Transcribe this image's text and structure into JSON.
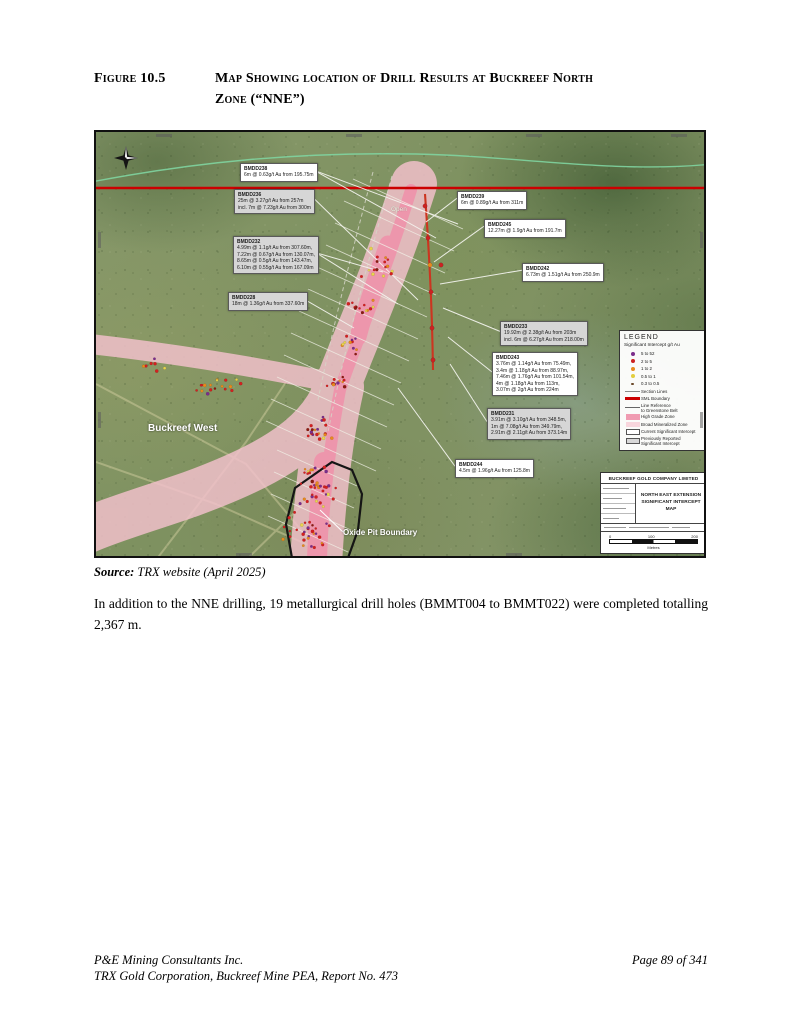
{
  "figure": {
    "label": "Figure 10.5",
    "title_line1": "Map Showing location of Drill Results at Buckreef North",
    "title_line2": "Zone (“NNE”)"
  },
  "source": {
    "prefix": "Source:",
    "text": " TRX website (April 2025)"
  },
  "body": "In addition to the NNE drilling, 19 metallurgical drill holes (BMMT004 to BMMT022) were completed totalling 2,367 m.",
  "footer": {
    "line1": "P&E Mining Consultants Inc.",
    "line2": "TRX Gold Corporation, Buckreef Mine PEA, Report No. 473",
    "page": "Page 89 of 341"
  },
  "map": {
    "labels": {
      "open": "Open",
      "buckreef_west": "Buckreef West",
      "oxide_pit_boundary": "Oxide Pit Boundary"
    },
    "callouts": [
      {
        "id": "BMDD238",
        "style": "white",
        "x": 144,
        "y": 31,
        "lines": [
          "6m @ 0.63g/t Au from 195.75m"
        ],
        "targets": [
          [
            340,
            106
          ],
          [
            362,
            92
          ]
        ]
      },
      {
        "id": "BMDD236",
        "style": "gray",
        "x": 138,
        "y": 57,
        "lines": [
          "25m @ 3.27g/t Au from 257m",
          "incl. 7m @ 7.23g/t Au from 300m"
        ],
        "targets": [
          [
            322,
            168
          ]
        ]
      },
      {
        "id": "BMDD232",
        "style": "gray",
        "x": 137,
        "y": 104,
        "lines": [
          "4.99m @ 1.1g/t Au from 307.60m,",
          "7.22m @ 0.67g/t Au from 130.07m,",
          "8.65m @ 0.5g/t Au from 143.47m,",
          "6.10m @ 0.55g/t Au from 167.09m"
        ],
        "targets": [
          [
            287,
            140
          ],
          [
            302,
            172
          ]
        ]
      },
      {
        "id": "BMDD228",
        "style": "gray",
        "x": 132,
        "y": 160,
        "lines": [
          "18m @ 1.36g/t Au from 337.60m"
        ],
        "targets": [
          [
            258,
            196
          ]
        ]
      },
      {
        "id": "BMDD239",
        "style": "white",
        "x": 361,
        "y": 59,
        "lines": [
          "6m @ 0.89g/t Au from 311m"
        ],
        "targets": [
          [
            330,
            90
          ]
        ]
      },
      {
        "id": "BMDD245",
        "style": "white",
        "x": 388,
        "y": 87,
        "lines": [
          "12.27m @ 1.9g/t Au from 191.7m"
        ],
        "targets": [
          [
            338,
            130
          ]
        ]
      },
      {
        "id": "BMDD242",
        "style": "white",
        "x": 426,
        "y": 131,
        "lines": [
          "6.73m @ 1.51g/t Au from 250.9m"
        ],
        "targets": [
          [
            344,
            152
          ]
        ]
      },
      {
        "id": "BMDD233",
        "style": "gray",
        "x": 404,
        "y": 189,
        "lines": [
          "19.92m @ 2.38g/t Au from 203m",
          "incl. 6m @ 6.27g/t Au from 218.00m"
        ],
        "targets": [
          [
            347,
            176
          ]
        ]
      },
      {
        "id": "BMDD243",
        "style": "white",
        "x": 396,
        "y": 220,
        "lines": [
          "3.76m @ 1.14g/t Au from 75.49m,",
          "3.4m @ 1.18g/t Au from 88.97m,",
          "7.46m @ 1.76g/t Au from 101.54m,",
          "4m @ 1.18g/t Au from 113m,",
          "3.07m @ 2g/t Au from 224m"
        ],
        "targets": [
          [
            352,
            205
          ]
        ]
      },
      {
        "id": "BMDD231",
        "style": "gray",
        "x": 391,
        "y": 276,
        "lines": [
          "3.91m @ 3.10g/t Au from 348.5m,",
          "1m @ 7.08g/t Au from 349.79m,",
          "2.91m @ 2.11g/t Au from 373.14m"
        ],
        "targets": [
          [
            354,
            232
          ]
        ]
      },
      {
        "id": "BMDD244",
        "style": "white",
        "x": 359,
        "y": 327,
        "lines": [
          "4.5m @ 1.96g/t Au from 125.8m"
        ],
        "targets": [
          [
            302,
            256
          ]
        ]
      }
    ],
    "markers": [
      {
        "x": 329,
        "y": 74,
        "c": "#cc2222"
      },
      {
        "x": 332,
        "y": 106,
        "c": "#cc2222"
      },
      {
        "x": 334,
        "y": 133,
        "c": "#e78a1e"
      },
      {
        "x": 335,
        "y": 160,
        "c": "#cc2222"
      },
      {
        "x": 336,
        "y": 196,
        "c": "#cc2222"
      },
      {
        "x": 337,
        "y": 228,
        "c": "#cc2222"
      },
      {
        "x": 345,
        "y": 133,
        "c": "#cc2222"
      }
    ],
    "dot_clusters": [
      {
        "cx": 284,
        "cy": 133,
        "n": 16,
        "r": 20
      },
      {
        "cx": 266,
        "cy": 172,
        "n": 13,
        "r": 17
      },
      {
        "cx": 249,
        "cy": 212,
        "n": 11,
        "r": 15
      },
      {
        "cx": 239,
        "cy": 253,
        "n": 13,
        "r": 16
      },
      {
        "cx": 222,
        "cy": 298,
        "n": 20,
        "r": 20
      },
      {
        "cx": 220,
        "cy": 352,
        "n": 38,
        "r": 28
      },
      {
        "cx": 212,
        "cy": 398,
        "n": 30,
        "r": 26
      },
      {
        "cx": 118,
        "cy": 252,
        "n": 18,
        "r": 34,
        "ry": 12
      },
      {
        "cx": 58,
        "cy": 232,
        "n": 8,
        "r": 22,
        "ry": 8
      }
    ],
    "dot_colors": [
      {
        "c": "#d42020",
        "w": 0.46
      },
      {
        "c": "#e88a1c",
        "w": 0.22
      },
      {
        "c": "#7b2d8b",
        "w": 0.15
      },
      {
        "c": "#e8d44d",
        "w": 0.11
      },
      {
        "c": "#8c1a10",
        "w": 0.06
      }
    ],
    "legend": {
      "title": "LEGEND",
      "subtitle": "Significant Intercept g/t Au",
      "items": [
        {
          "swatch": "dot",
          "color": "#7b2d8b",
          "label": "5  to  52"
        },
        {
          "swatch": "dot",
          "color": "#cc2222",
          "label": "2  to  5"
        },
        {
          "swatch": "dot",
          "color": "#e78a1e",
          "label": "1  to  2"
        },
        {
          "swatch": "dot",
          "color": "#e3cf3f",
          "label": "0.5  to  1"
        },
        {
          "swatch": "dot-small",
          "color": "#6b4a2a",
          "label": "0.3  to  0.5"
        },
        {
          "swatch": "line-thin",
          "color": "#8a8a8a",
          "label": "Section Lines"
        },
        {
          "swatch": "line-thick",
          "color": "#cc0000",
          "label": "SML Boundary"
        },
        {
          "swatch": "line-thin",
          "color": "#666666",
          "label": "Line Reference\nto Greenstone Belt"
        },
        {
          "swatch": "area",
          "color": "#f09cb2",
          "label": "High Grade Zone"
        },
        {
          "swatch": "area",
          "color": "#f8d6dd",
          "label": "Broad Mineralized Zone"
        },
        {
          "swatch": "box-white",
          "color": "#ffffff",
          "label": "Current Significant Intercept"
        },
        {
          "swatch": "box-gray",
          "color": "#d8d8d8",
          "label": "Previously Reported\nSignificant Intercept"
        }
      ]
    },
    "title_block": {
      "company": "BUCKREEF GOLD COMPANY LIMITED",
      "map_title1": "NORTH EAST EXTENSION",
      "map_title2": "SIGNIFICANT INTERCEPT MAP",
      "scale_ticks": [
        "0",
        "100",
        "200"
      ],
      "scale_unit": "Metres"
    }
  }
}
